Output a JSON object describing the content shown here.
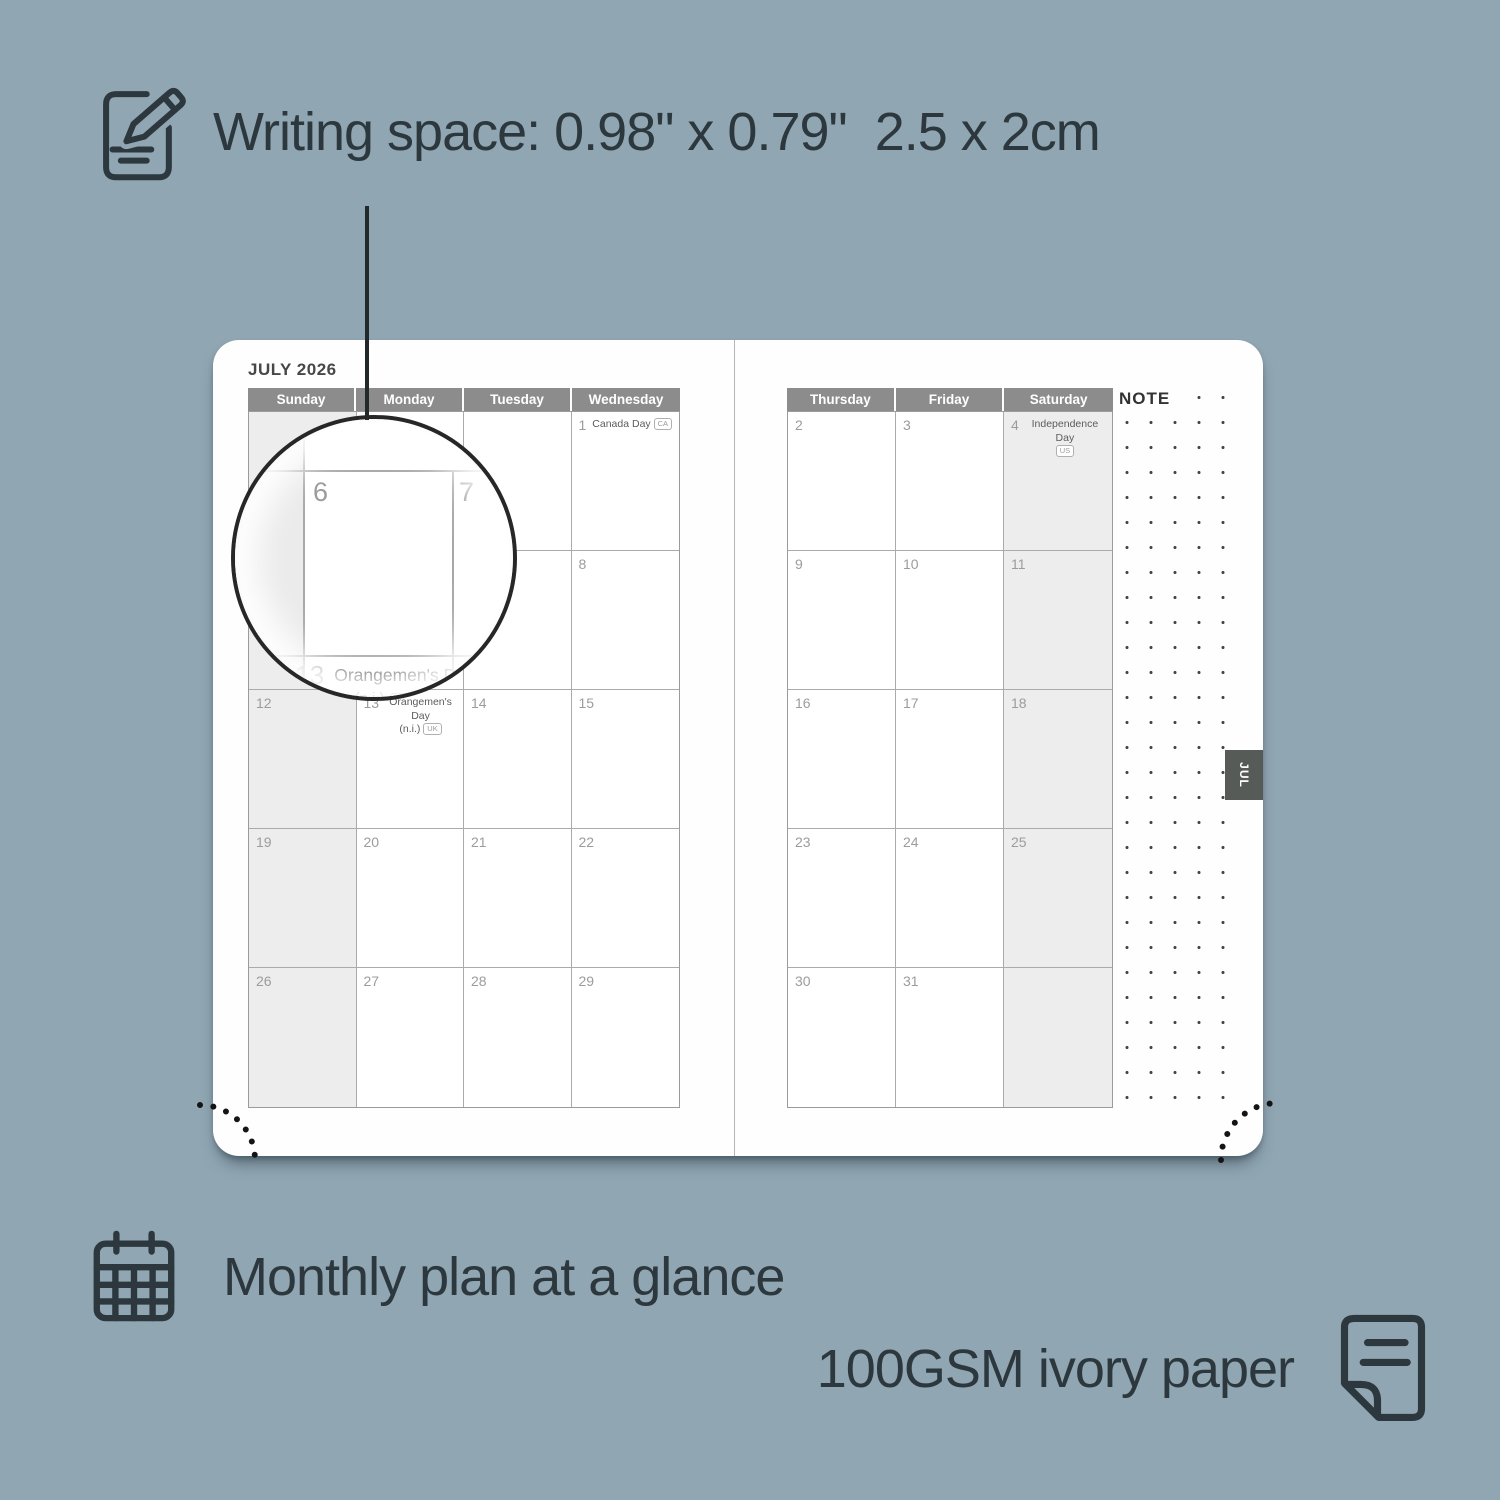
{
  "colors": {
    "background": "#90a6b2",
    "page": "#fefefe",
    "header_bg": "#8c8c8c",
    "shaded_cell": "#ededed",
    "grid_line": "#ababab",
    "date_number": "#9c9c9c",
    "dark_text": "#2c383e",
    "tab_bg": "#565b58"
  },
  "annotations": {
    "writing_space": "Writing space: 0.98\" x 0.79\"  2.5 x 2cm",
    "monthly_plan": "Monthly plan at a glance",
    "paper": "100GSM ivory paper"
  },
  "planner": {
    "month_title": "JULY 2026",
    "tab_label": "JUL",
    "note_label": "NOTE",
    "left_page": {
      "day_headers": [
        "Sunday",
        "Monday",
        "Tuesday",
        "Wednesday"
      ],
      "weeks": [
        [
          {},
          {},
          {},
          {
            "date": "1",
            "holiday": "Canada Day",
            "badge": "CA",
            "badge_inline": true
          }
        ],
        [
          {},
          {
            "date": "6"
          },
          {
            "date": "7"
          },
          {
            "date": "8"
          }
        ],
        [
          {
            "date": "12"
          },
          {
            "date": "13",
            "holiday": "Orangemen's Day",
            "line2": "(n.i.)",
            "badge": "UK"
          },
          {
            "date": "14"
          },
          {
            "date": "15"
          }
        ],
        [
          {
            "date": "19"
          },
          {
            "date": "20"
          },
          {
            "date": "21"
          },
          {
            "date": "22"
          }
        ],
        [
          {
            "date": "26"
          },
          {
            "date": "27"
          },
          {
            "date": "28"
          },
          {
            "date": "29"
          }
        ]
      ]
    },
    "right_page": {
      "day_headers": [
        "Thursday",
        "Friday",
        "Saturday"
      ],
      "weeks": [
        [
          {
            "date": "2"
          },
          {
            "date": "3"
          },
          {
            "date": "4",
            "holiday": "Independence Day",
            "line2": "",
            "badge": "US"
          }
        ],
        [
          {
            "date": "9"
          },
          {
            "date": "10"
          },
          {
            "date": "11"
          }
        ],
        [
          {
            "date": "16"
          },
          {
            "date": "17"
          },
          {
            "date": "18"
          }
        ],
        [
          {
            "date": "23"
          },
          {
            "date": "24"
          },
          {
            "date": "25"
          }
        ],
        [
          {
            "date": "30"
          },
          {
            "date": "31"
          },
          {}
        ]
      ]
    },
    "magnifier": {
      "date_monday": "6",
      "date_tuesday": "7",
      "date_holiday": "13",
      "holiday": "Orangemen's Day",
      "suffix": "(n.i.)",
      "badge": "UK"
    }
  }
}
